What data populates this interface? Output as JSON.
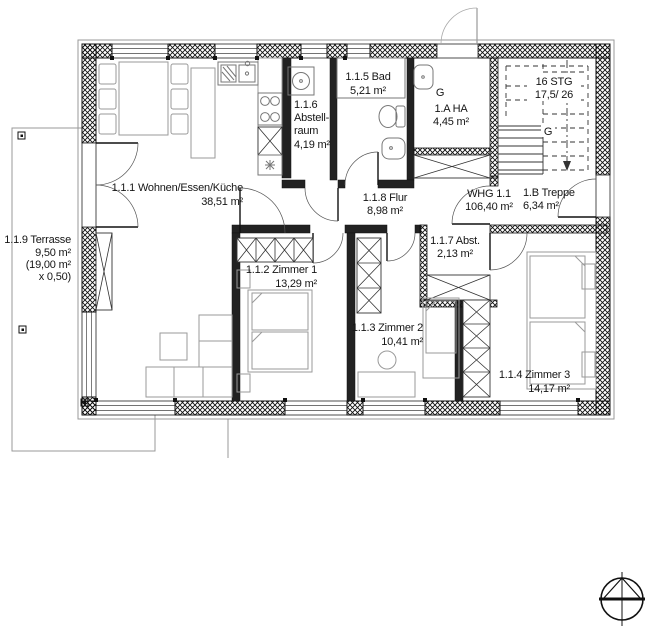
{
  "drawing_title": "Grundriss Wohnung WHG 1.1",
  "colors": {
    "line": "#111111",
    "furniture": "#9a9a9a",
    "background": "#ffffff",
    "text": "#151515"
  },
  "apartment": {
    "lines": [
      "WHG 1.1",
      "106,40 m²"
    ]
  },
  "rooms": [
    {
      "id": "1.1.1",
      "name": "Wohnen/Essen/Küche",
      "area": "38,51 m²",
      "lines": [
        "1.1.1 Wohnen/Essen/Küche",
        "38,51 m²"
      ]
    },
    {
      "id": "1.1.2",
      "name": "Zimmer 1",
      "area": "13,29 m²",
      "lines": [
        "1.1.2 Zimmer 1",
        "13,29 m²"
      ]
    },
    {
      "id": "1.1.3",
      "name": "Zimmer 2",
      "area": "10,41 m²",
      "lines": [
        "1.1.3 Zimmer 2",
        "10,41 m²"
      ]
    },
    {
      "id": "1.1.4",
      "name": "Zimmer 3",
      "area": "14,17 m²",
      "lines": [
        "1.1.4 Zimmer 3",
        "14,17 m²"
      ]
    },
    {
      "id": "1.1.5",
      "name": "Bad",
      "area": "5,21 m²",
      "lines": [
        "1.1.5 Bad",
        "5,21 m²"
      ]
    },
    {
      "id": "1.1.6",
      "name": "Abstellraum",
      "area": "4,19 m²",
      "lines": [
        "1.1.6",
        "Abstell-",
        "raum",
        "4,19 m²"
      ]
    },
    {
      "id": "1.1.7",
      "name": "Abst.",
      "area": "2,13 m²",
      "lines": [
        "1.1.7 Abst.",
        "2,13 m²"
      ]
    },
    {
      "id": "1.1.8",
      "name": "Flur",
      "area": "8,98 m²",
      "lines": [
        "1.1.8 Flur",
        "8,98 m²"
      ]
    },
    {
      "id": "1.1.9",
      "name": "Terrasse",
      "area": "9,50 m²",
      "lines": [
        "1.1.9 Terrasse",
        "9,50 m²",
        "(19,00 m²",
        "x 0,50)"
      ]
    },
    {
      "id": "1.A",
      "name": "HA",
      "area": "4,45 m²",
      "lines": [
        "1.A HA",
        "4,45 m²"
      ]
    },
    {
      "id": "1.B",
      "name": "Treppe",
      "area": "6,34 m²",
      "lines": [
        "1.B Treppe",
        "6,34 m²"
      ]
    }
  ],
  "stairs": {
    "lines": [
      "16 STG",
      "17,5/ 26"
    ]
  },
  "drains": {
    "ha": "G",
    "stair": "G"
  }
}
